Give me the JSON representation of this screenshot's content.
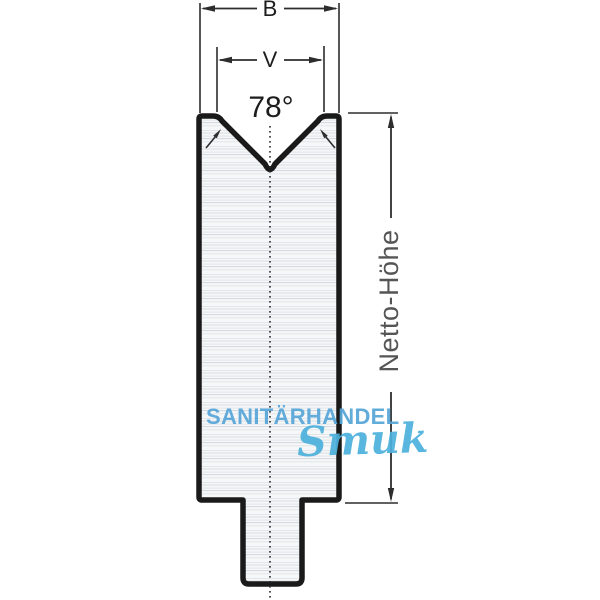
{
  "canvas": {
    "width": 600,
    "height": 600,
    "background": "#ffffff"
  },
  "drawing": {
    "title": "V-die cross-section technical drawing",
    "dimensions": {
      "width_label": "B",
      "opening_label": "V",
      "angle_label": "78°",
      "height_label": "Netto-Höhe"
    },
    "colors": {
      "outline": "#1a1a1a",
      "dimension_lines": "#2d2d2d",
      "label_text": "#1d1d1d",
      "height_label_text": "#555555",
      "body_fill": "#f5f7f8",
      "streaks": "#d6dbdf"
    }
  },
  "watermark": {
    "brand": "SANITÄRHANDEL",
    "script": "Smuk",
    "brand_color": "#57a6d8",
    "script_color": "#4db1dc"
  }
}
